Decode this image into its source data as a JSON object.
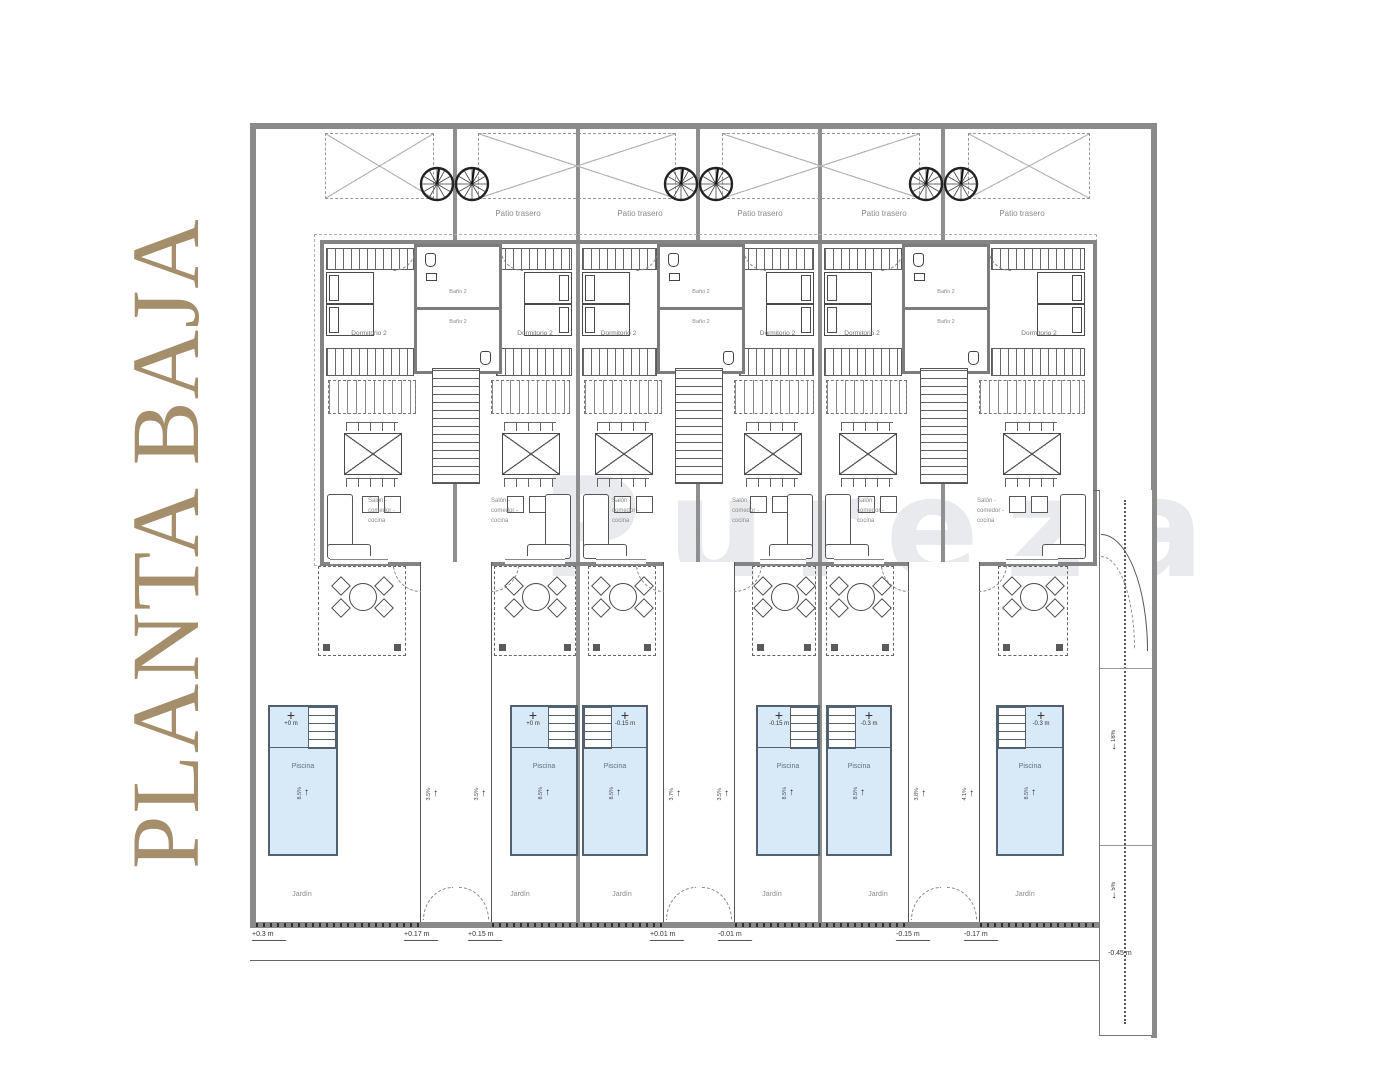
{
  "title": "PLANTA BAJA",
  "watermark": "Pureza",
  "colors": {
    "title": "#a58e6c",
    "pool_fill": "#d8e9f8",
    "pool_border": "#51616f",
    "wall_gray": "#8a8a8a",
    "watermark": "#e3e6e9"
  },
  "labels": {
    "patio": "Patio trasero",
    "dormitorio": "Dormitorio 2",
    "bano": "Baño 2",
    "distribuidor": "Distribuidor 1",
    "salon": [
      "Salón -",
      "comedor -",
      "cocina"
    ],
    "piscina": "Piscina",
    "jardin": "Jardín"
  },
  "glyphs": {
    "cross": "+",
    "arrow_up": "↑",
    "arrow_down": "↓"
  },
  "pools": {
    "slope": "8.5%",
    "elevations": [
      "+0 m",
      "+0 m",
      "-0.15 m",
      "-0.15 m",
      "-0.3 m",
      "-0.3 m"
    ]
  },
  "driveways": {
    "lane_slopes": [
      "3.5%",
      "3.5%",
      "3.7%",
      "3.5%",
      "3.8%",
      "4.1%"
    ]
  },
  "ramp": {
    "slope_upper": "18%",
    "slope_lower": "5%",
    "level": "-0.45 m"
  },
  "street_levels": [
    "+0.3 m",
    "+0.17 m",
    "+0.15 m",
    "+0.01 m",
    "-0.01 m",
    "-0.15 m",
    "-0.17 m"
  ]
}
